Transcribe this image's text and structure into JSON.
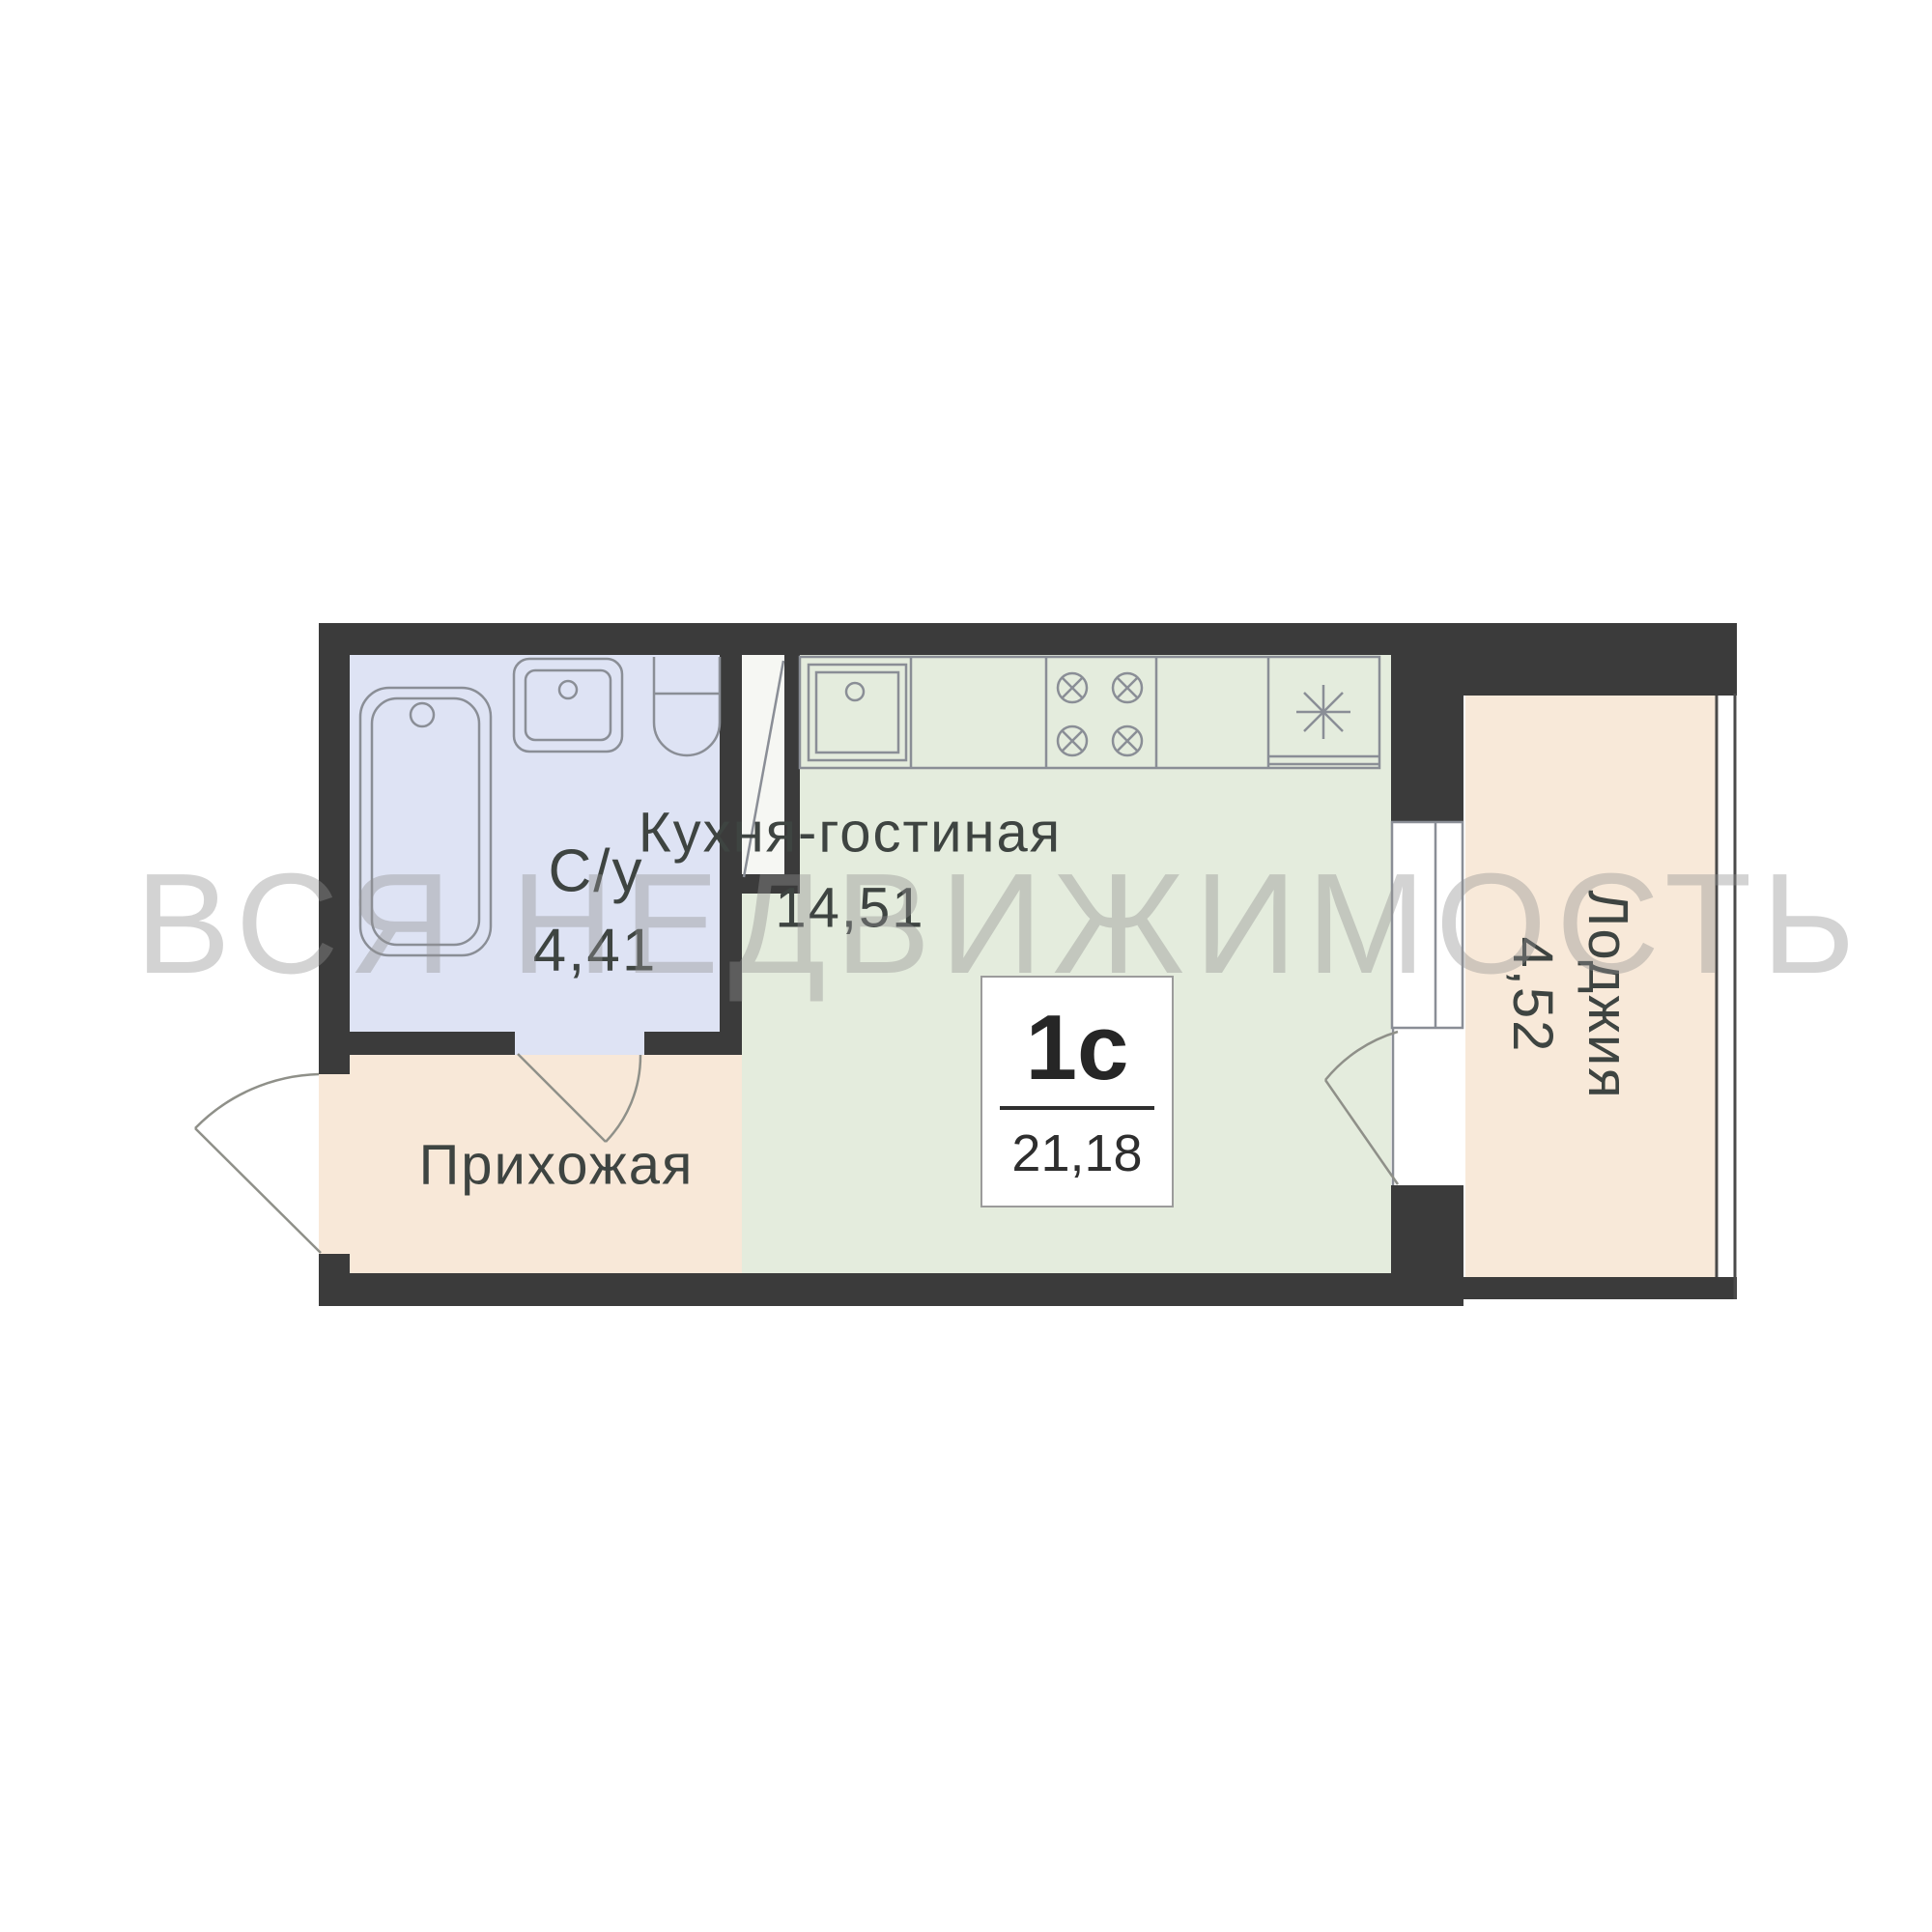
{
  "watermark": {
    "text": "ВСЯ НЕДВИЖИМОСТЬ",
    "color": "#939393"
  },
  "unit": {
    "type": "1с",
    "area": "21,18"
  },
  "rooms": {
    "kitchen_living": {
      "name": "Кухня-гостиная",
      "area": "14,51",
      "color": "#e4ecdd"
    },
    "bathroom": {
      "name": "С/у",
      "area": "4,41",
      "color": "#dee3f4"
    },
    "hallway": {
      "name": "Прихожая",
      "color": "#f8e8d8"
    },
    "loggia": {
      "name": "Лоджия",
      "area": "4,52",
      "color": "#f8e9d9"
    },
    "shaft": {
      "color": "#f6f7f3"
    }
  },
  "colors": {
    "wall": "#3b3b3b",
    "fixture_line": "#8a8e96",
    "door_line": "#8f9089",
    "label_text": "#3e4441",
    "background": "#ffffff"
  },
  "fixtures": [
    "bathtub-icon",
    "bathroom-sink-icon",
    "toilet-icon",
    "vent-shaft-icon",
    "kitchen-counter-icon",
    "kitchen-sink-icon",
    "stove-icon",
    "fridge-icon",
    "window-icon",
    "entrance-door-icon",
    "bathroom-door-icon",
    "balcony-door-icon"
  ]
}
